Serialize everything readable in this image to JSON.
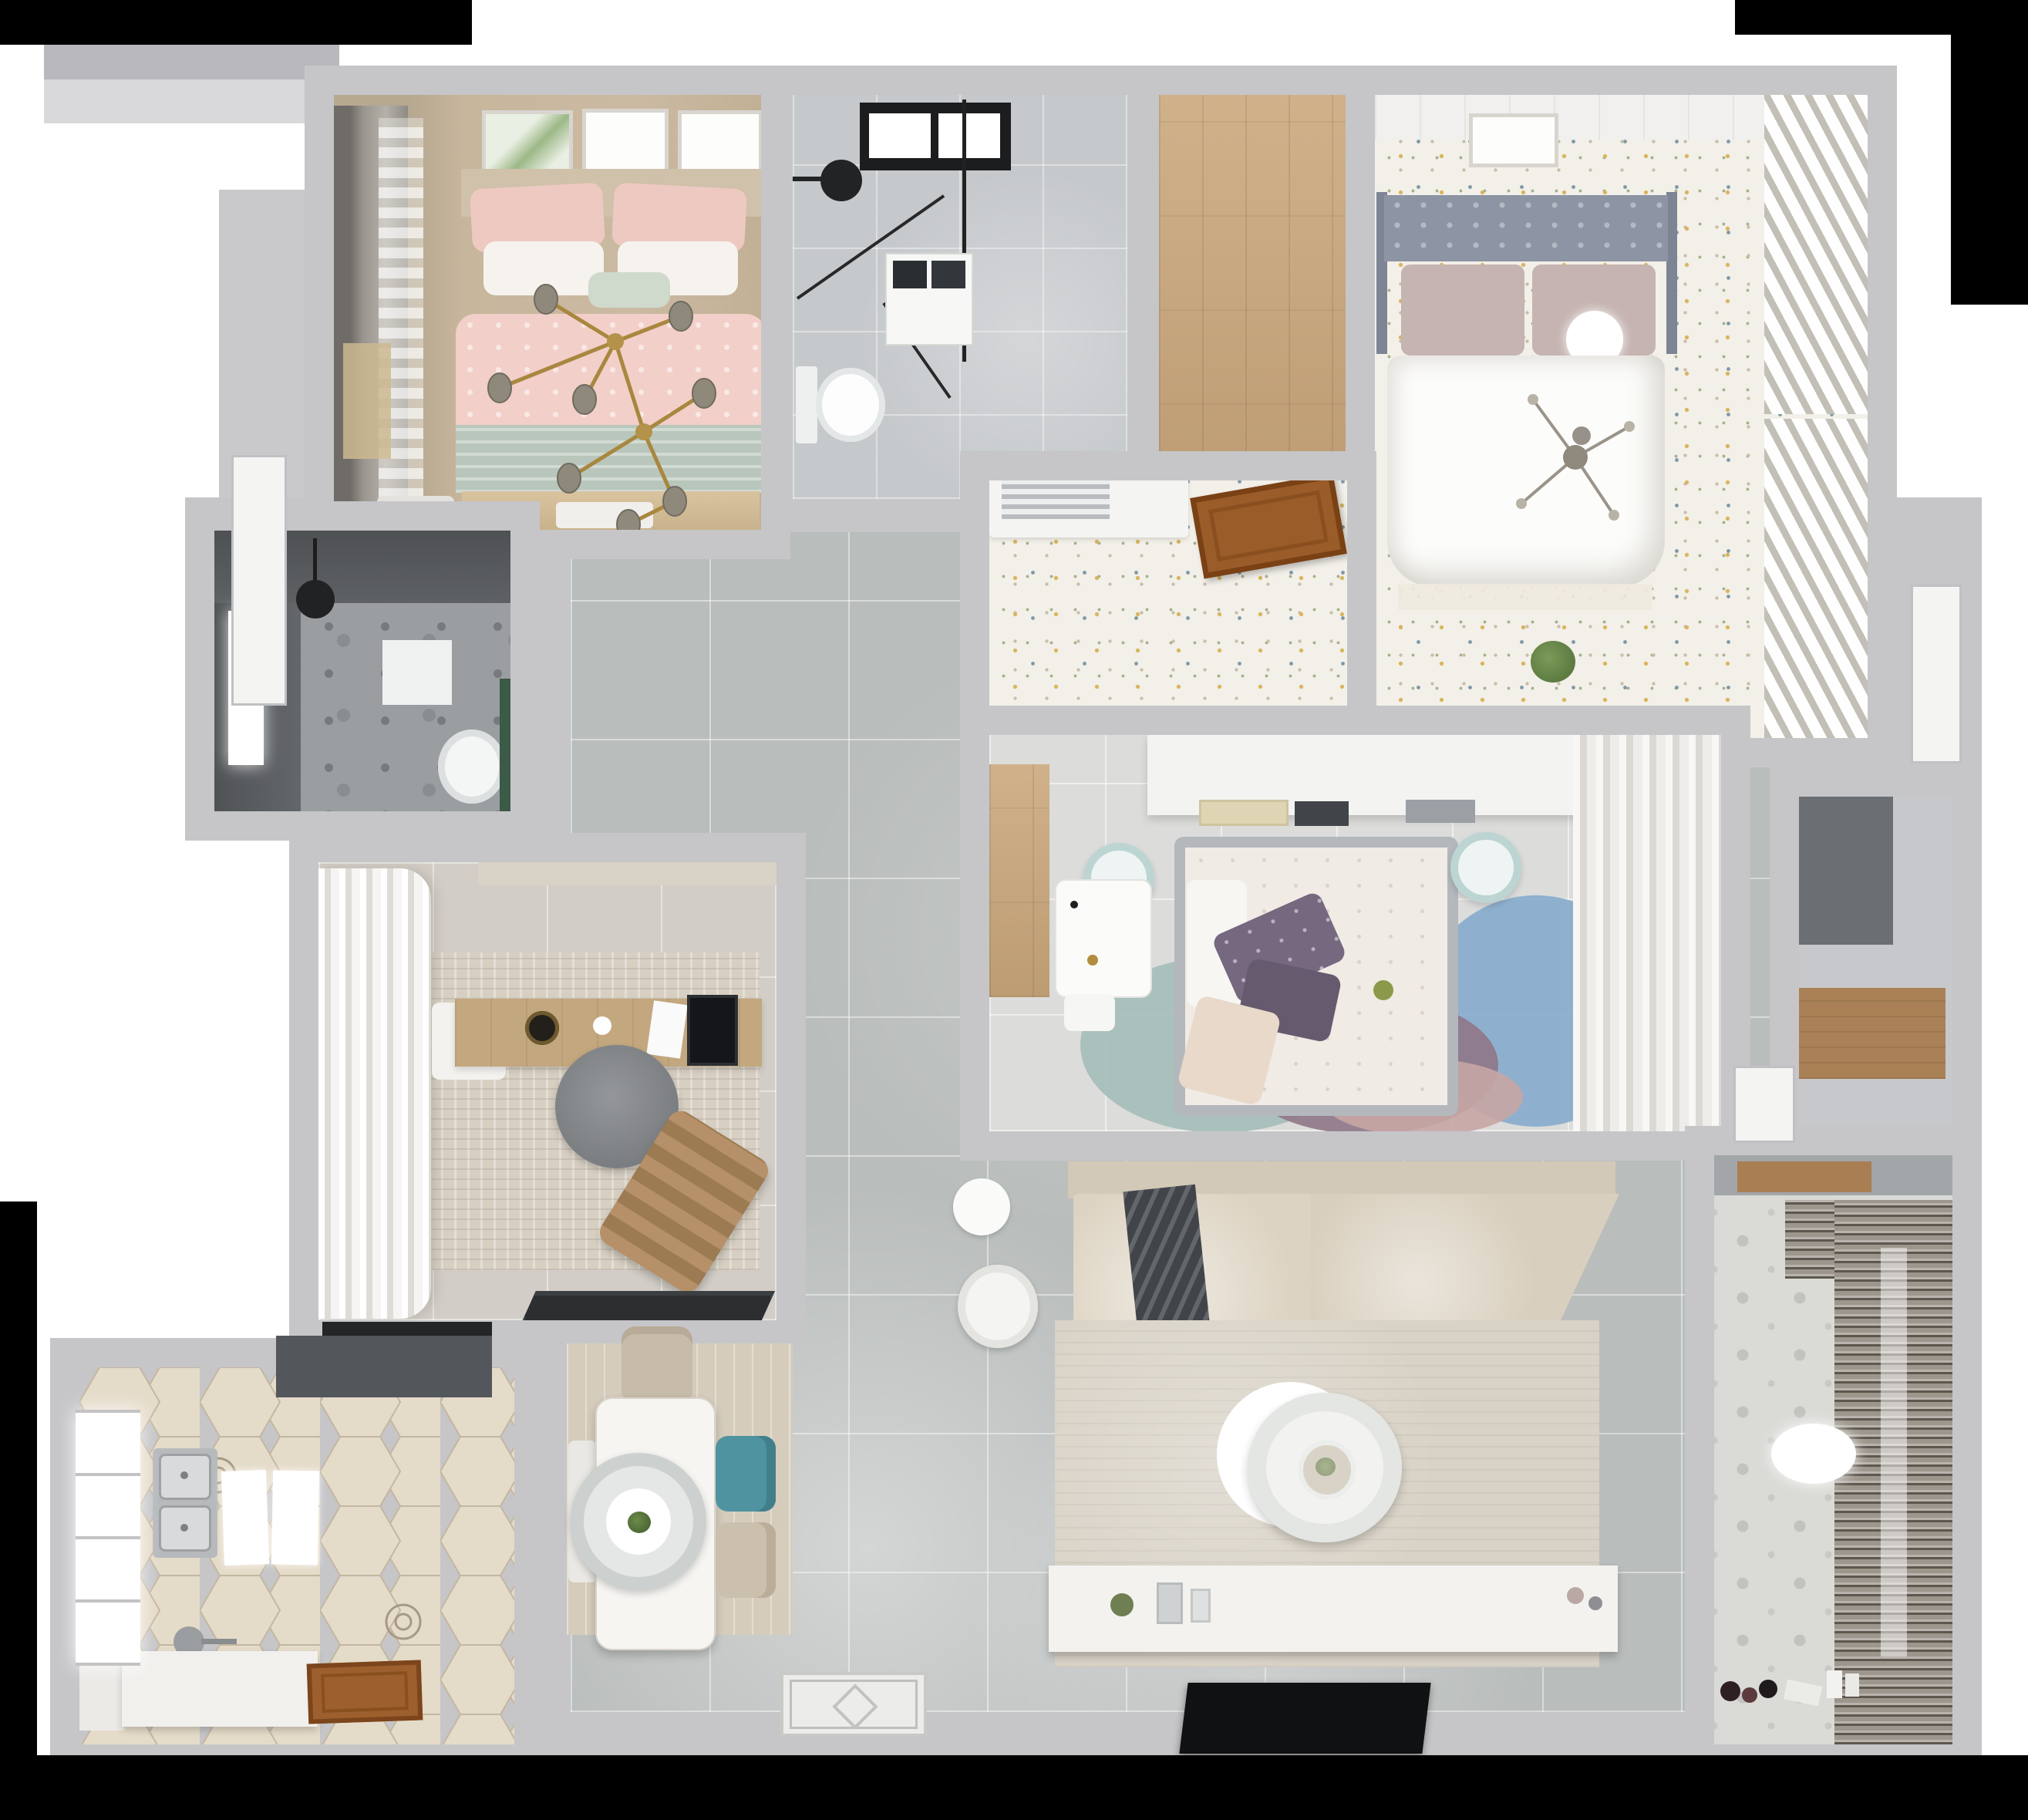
{
  "scene": {
    "type": "3d-floorplan-top-down-render",
    "description": "Photorealistic top-down 3D render of a furnished multi-room apartment floor plan on a white canvas with black matte edges",
    "rooms": [
      {
        "label": "Bedroom with pink bedding",
        "furniture": [
          "double bed",
          "pink patterned duvet",
          "sage green throw",
          "white and pink pillows",
          "mint accent pillow",
          "gold branch chandelier with smoked glass globes",
          "three wall art frames",
          "gray drape and sheer curtains",
          "beige roman shade",
          "nightstand",
          "bed-end bench",
          "tan fringe rug"
        ]
      },
      {
        "label": "Shower bathroom",
        "furniture": [
          "black framed window",
          "black rain shower head",
          "black framed glass shower enclosure",
          "white vanity with dark art tiles",
          "toilet",
          "marble gray floor tiles"
        ]
      },
      {
        "label": "Wardrobe corridor",
        "furniture": [
          "wood plank floor",
          "white threshold sill"
        ]
      },
      {
        "label": "Master bedroom",
        "furniture": [
          "gray tufted headboard",
          "two mauve pillows",
          "white sphere lamp",
          "white duvet",
          "gray branch chandelier",
          "white ceiling planks",
          "botanical art frame",
          "louvered closet doors",
          "speckled carpet floor",
          "potted plant on ledge"
        ]
      },
      {
        "label": "Master entry corridor",
        "furniture": [
          "white air-conditioner vent unit",
          "open brown wooden door",
          "speckled carpet floor"
        ]
      },
      {
        "label": "Dark tiled bathroom",
        "furniture": [
          "bright window",
          "black pendant shower light",
          "wall towel box",
          "toilet",
          "green accent panel",
          "marble speckled floor"
        ]
      },
      {
        "label": "Study",
        "furniture": [
          "white ruffled curtains",
          "side window",
          "textured beige rug",
          "wood writing desk",
          "black desktop monitor",
          "white laptop",
          "black plant pot",
          "white chair",
          "gray round office chair",
          "brown striped lounge chair",
          "black door mat",
          "beige roller shade"
        ]
      },
      {
        "label": "Second bedroom",
        "furniture": [
          "bed with gray frame and floral duvet",
          "two purple pillows",
          "beige pillow",
          "white fold sheet",
          "headboard shelf with books",
          "two pale blue round stools",
          "white desk with accessories",
          "white stool",
          "overlapping circle rug in teal blue mauve blush",
          "wood floor strip",
          "sheer closet curtains"
        ]
      },
      {
        "label": "Kitchen",
        "furniture": [
          "hexagonal cream tile floor",
          "dark range hood",
          "double stainless steel sink",
          "faucet",
          "two white counter mats",
          "white island counter",
          "left wall counter",
          "bright window",
          "brown wooden entry door"
        ]
      },
      {
        "label": "Dining area",
        "furniture": [
          "light wood area rug",
          "white rectangular dining table",
          "oval layered pendant lamp with plant centerpiece",
          "beige chair",
          "teal chair",
          "second beige chair",
          "white bench",
          "ornamental entry mat"
        ]
      },
      {
        "label": "Living room",
        "furniture": [
          "beige corner sofa with chaise",
          "dark gray throw blanket",
          "large beige rug",
          "round two-tier white coffee table with plant sprig",
          "white round armchair",
          "white round side table",
          "long white TV console with decor objects",
          "black flat television",
          "gray floor tiles"
        ]
      },
      {
        "label": "Storage niche",
        "furniture": [
          "shadowed alcove",
          "wood shelf ledge"
        ]
      },
      {
        "label": "Balcony laundry",
        "furniture": [
          "patterned cement tile floor",
          "slatted drying rack blinds",
          "wood window sill",
          "white oval ceiling light",
          "toy cluster",
          "white cups",
          "paper sheet"
        ]
      },
      {
        "label": "Hallway",
        "furniture": [
          "large gray floor tiles",
          "white open doors"
        ]
      }
    ],
    "palette": {
      "wall": "#c6c6c9",
      "wallDark": "#b9b9bd",
      "matte": "#000000",
      "hallTile": "#b9bdbc",
      "bedroom1Floor": "#c7b59c",
      "pinkDuvet": "#f2cfc8",
      "sageThrow": "#b9c6bb",
      "goldChandelier": "#a8873f",
      "globeGlass": "#8f897c",
      "bathTopFloor": "#c6c9cc",
      "woodFloor": "#c9a67a",
      "speckleCarpet": "#f3f0e9",
      "masterHeadboard": "#8d94a3",
      "masterPillow": "#c5b4b1",
      "duvetWhite": "#fcfcfa",
      "louverCloset": "#efeeea",
      "darkBathWall": "#63666a",
      "studyRug": "#d7cfc2",
      "deskWood": "#c3a77e",
      "officeChair": "#8c8f92",
      "loungeChair": "#a28057",
      "bed2Frame": "#b4b8bd",
      "purplePillow": "#75687f",
      "rugTeal": "#a4bdb8",
      "rugBlue": "#85abcc",
      "rugMauve": "#8f7787",
      "rugBlush": "#c7a6a4",
      "stoolBlue": "#bcd5d2",
      "hexTileLight": "#eee6d8",
      "hexTileDark": "#e5dbc9",
      "rangeHood": "#53575b",
      "woodDoor": "#9a5c28",
      "diningRug": "#d5ccbc",
      "tableWhite": "#f6f5f2",
      "tealChair": "#4f93a0",
      "beigeChair": "#cbc0ae",
      "sofaBeige": "#d9cfbe",
      "sofaChaise": "#ddd3c2",
      "throwDark": "#41454a",
      "livingRug": "#d9d3c7",
      "tvBlack": "#101112",
      "nicheWood": "#aa8156",
      "balconyFloor": "#dadad6",
      "balconySlats": "#9d968c",
      "accentGreen": "#3c5a46"
    }
  }
}
